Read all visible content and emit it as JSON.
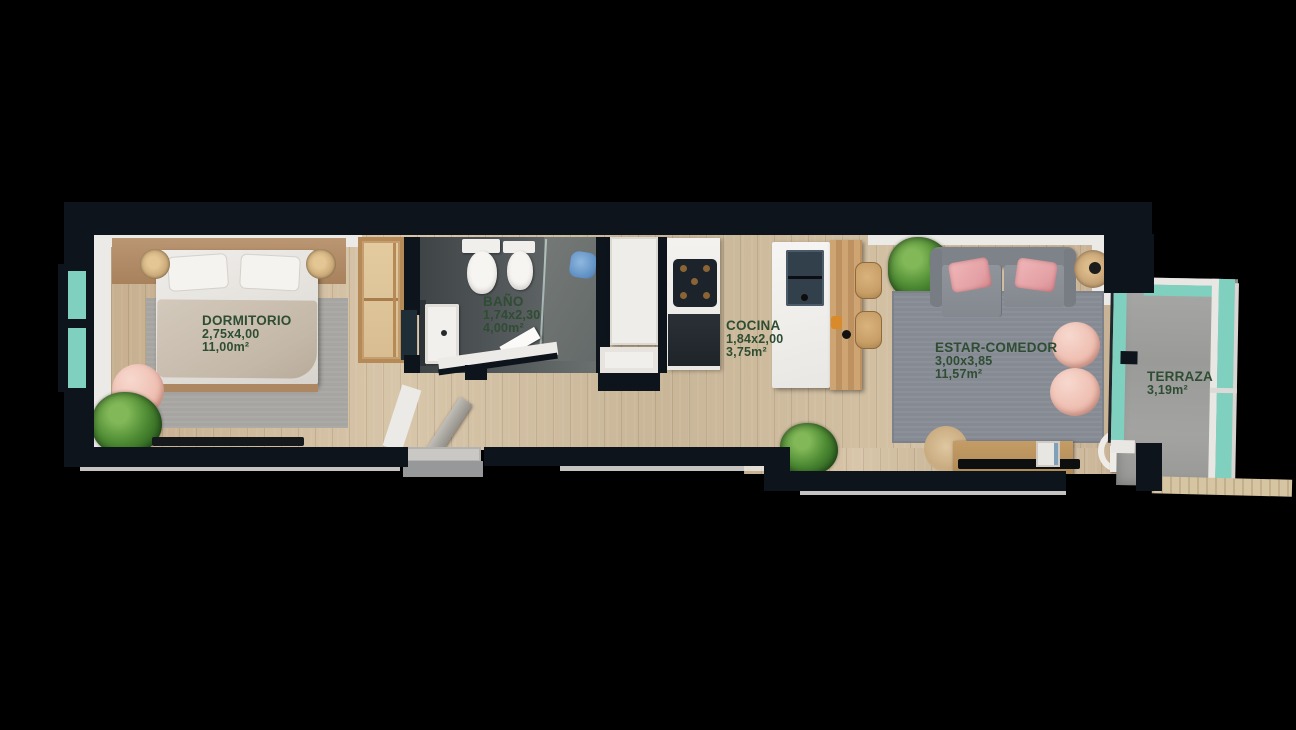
{
  "title": "Apartment floor plan",
  "rooms": {
    "dormitorio": {
      "name": "DORMITORIO",
      "dims": "2,75x4,00",
      "area": "11,00m²"
    },
    "bano": {
      "name": "BAÑO",
      "dims": "1,74x2,30",
      "area": "4,00m²"
    },
    "cocina": {
      "name": "COCINA",
      "dims": "1,84x2,00",
      "area": "3,75m²"
    },
    "estar_comedor": {
      "name": "ESTAR-COMEDOR",
      "dims": "3,00x3,85",
      "area": "11,57m²"
    },
    "terraza": {
      "name": "TERRAZA",
      "area": "3,19m²"
    }
  },
  "colors": {
    "background": "#000000",
    "wall": "#0e141b",
    "label_text": "#2e4d33",
    "glass": "#80d0c0",
    "wood_floor": "#cdb89c",
    "bath_floor": "#565b5d",
    "terrace_floor": "#a0a09e",
    "accent_pink": "#f0c6bd"
  }
}
